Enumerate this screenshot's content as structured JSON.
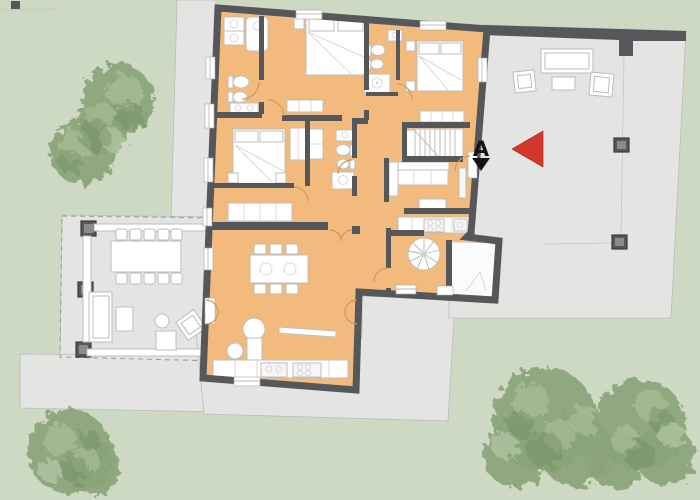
{
  "marker": {
    "label": "A"
  },
  "legend": {
    "entrance_arrow": "red-arrow-pointing-left",
    "section_marker": "black-triangle-down"
  },
  "colors": {
    "lawn": "#cdd9c3",
    "terrace": "#e4e4e3",
    "terrace_line": "#bcbcbc",
    "wall": "#55575a",
    "room": "#f2ba7d",
    "door_arc": "#cf9a55",
    "furniture_stroke": "#bdbdbd",
    "white_room": "#fbfbfb",
    "pergola_dash": "#98a694",
    "tree_base": "#8aa47a",
    "tree_light": "#adc39b",
    "tree_dark": "#6e8a5f",
    "tree_pale": "#c6d5b8",
    "marker_red": "#d5352b",
    "marker_black": "#141414",
    "stair_line": "#b5b5b5",
    "window_line": "#a9a9a9"
  }
}
